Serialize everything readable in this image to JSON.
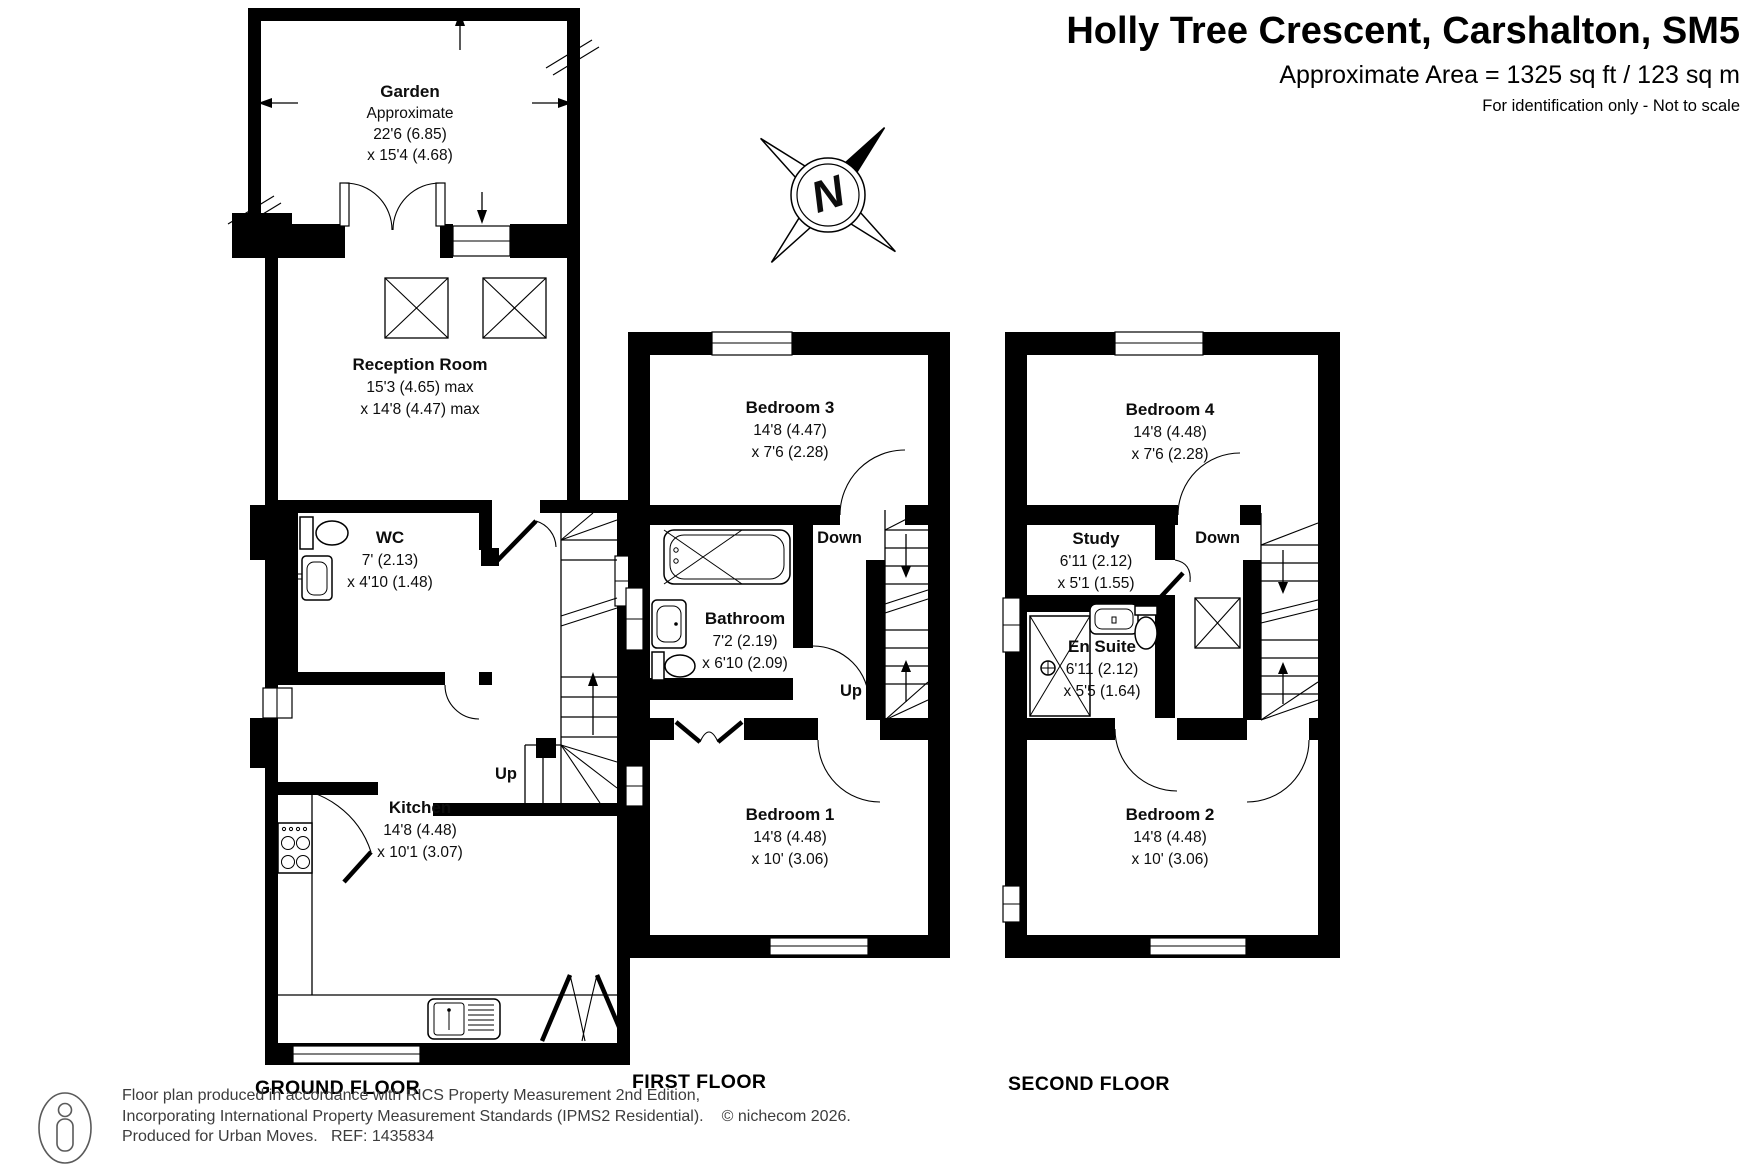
{
  "header": {
    "title": "Holly Tree Crescent, Carshalton, SM5",
    "area_line": "Approximate Area = 1325 sq ft / 123 sq m",
    "disclaimer": "For identification only - Not to scale"
  },
  "compass": {
    "letter": "N"
  },
  "floors": {
    "ground": {
      "label": "GROUND FLOOR",
      "stairs_up": "Up",
      "rooms": {
        "garden": {
          "name": "Garden",
          "approx": "Approximate",
          "dim1": "22'6 (6.85)",
          "dim2": "x 15'4 (4.68)"
        },
        "reception": {
          "name": "Reception Room",
          "dim1": "15'3 (4.65) max",
          "dim2": "x 14'8 (4.47) max"
        },
        "wc": {
          "name": "WC",
          "dim1": "7' (2.13)",
          "dim2": "x 4'10 (1.48)"
        },
        "kitchen": {
          "name": "Kitchen",
          "dim1": "14'8 (4.48)",
          "dim2": "x 10'1 (3.07)"
        }
      }
    },
    "first": {
      "label": "FIRST FLOOR",
      "stairs_down": "Down",
      "stairs_up": "Up",
      "rooms": {
        "bedroom3": {
          "name": "Bedroom 3",
          "dim1": "14'8 (4.47)",
          "dim2": "x 7'6 (2.28)"
        },
        "bathroom": {
          "name": "Bathroom",
          "dim1": "7'2 (2.19)",
          "dim2": "x 6'10 (2.09)"
        },
        "bedroom1": {
          "name": "Bedroom 1",
          "dim1": "14'8 (4.48)",
          "dim2": "x 10' (3.06)"
        }
      }
    },
    "second": {
      "label": "SECOND FLOOR",
      "stairs_down": "Down",
      "rooms": {
        "bedroom4": {
          "name": "Bedroom 4",
          "dim1": "14'8 (4.48)",
          "dim2": "x 7'6 (2.28)"
        },
        "study": {
          "name": "Study",
          "dim1": "6'11 (2.12)",
          "dim2": "x 5'1 (1.55)"
        },
        "ensuite": {
          "name": "En Suite",
          "dim1": "6'11 (2.12)",
          "dim2": "x 5'5 (1.64)"
        },
        "bedroom2": {
          "name": "Bedroom 2",
          "dim1": "14'8 (4.48)",
          "dim2": "x 10' (3.06)"
        }
      }
    }
  },
  "footer": {
    "line1": "Floor plan produced in accordance with RICS Property Measurement 2nd Edition,",
    "line2": "Incorporating International Property Measurement Standards (IPMS2 Residential).",
    "copyright": "© nichecom 2026.",
    "line3": "Produced for Urban Moves.   REF: 1435834"
  }
}
